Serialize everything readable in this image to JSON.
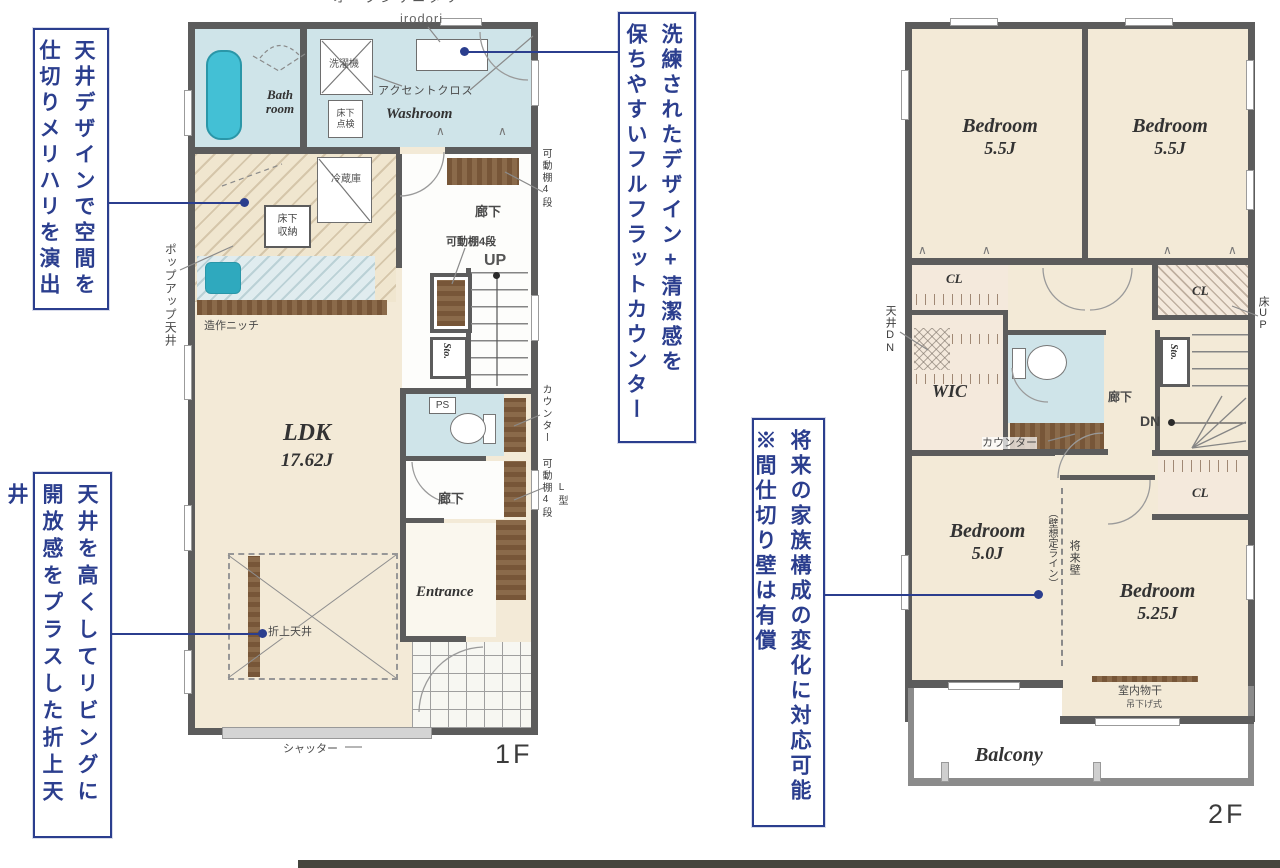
{
  "annotations": {
    "ceiling_design": {
      "line1": "天井デザインで空間を",
      "line2": "仕切りメリハリを演出"
    },
    "full_flat_counter": {
      "line1": "洗練されたデザイン+清潔感を",
      "line2": "保ちやすいフルフラットカウンター"
    },
    "folded_ceiling": {
      "line1": "天井を高くしてリビングに",
      "line2": "開放感をプラスした折上天井"
    },
    "partition_wall": {
      "line1": "将来の家族構成の変化に対応可能",
      "line2": "※間仕切り壁は有償"
    }
  },
  "floor1": {
    "floor_label": "1F",
    "open_sanitary": "オープンサニタリー",
    "irodori": "irodori",
    "accent_cross": "アクセントクロス",
    "washroom": "Washroom",
    "bath_line1": "Bath",
    "bath_line2": "room",
    "washer": "洗濯機",
    "underfloor_check_line1": "床下",
    "underfloor_check_line2": "点検",
    "fridge": "冷蔵庫",
    "underfloor_storage_line1": "床下",
    "underfloor_storage_line2": "収納",
    "popup_ceiling": "ポップアップ天井",
    "niche": "造作ニッチ",
    "ldk": "LDK",
    "ldk_size": "17.62J",
    "corridor": "廊下",
    "shelf_4": "可動棚4段",
    "up": "UP",
    "sto": "Sto.",
    "counter": "カウンター",
    "ps": "PS",
    "l_shape": "L型",
    "entrance": "Entrance",
    "folded_ceiling": "折上天井",
    "shutter": "シャッター"
  },
  "floor2": {
    "floor_label": "2F",
    "bedroom": "Bedroom",
    "size_55": "5.5J",
    "size_50": "5.0J",
    "size_525": "5.25J",
    "cl": "CL",
    "wic": "WIC",
    "ceiling_dn": "天井DN",
    "floor_up": "床UP",
    "sto": "Sto.",
    "dn": "DN",
    "corridor": "廊下",
    "counter": "カウンター",
    "future_wall": "将来壁",
    "wall_line": "（壁想定ライン）",
    "indoor_drying": "室内物干",
    "drying_type": "吊下げ式",
    "balcony": "Balcony"
  },
  "colors": {
    "annotation": "#2b3e8e",
    "fixture_teal": "#43c0d5",
    "wet_room": "#cfe4e9",
    "floor_cream": "#f3ead7",
    "wood": "#7d5c3e",
    "wall": "#5c5c5c"
  }
}
